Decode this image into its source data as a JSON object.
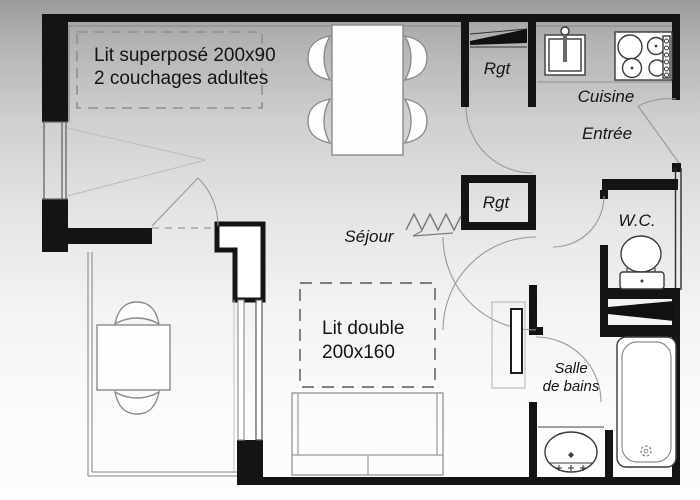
{
  "title": "Plan d'appartement",
  "colors": {
    "wall": "#141414",
    "furniture_line": "#8a8a8a",
    "fixture_line": "#3a3a3a",
    "dashed_zone": "#8f8f8f",
    "background_top": "#9c9c9c",
    "background_bottom": "#fdfdfd",
    "text": "#151515"
  },
  "labels": {
    "bunk_room": {
      "line1": "Lit superposé 200x90",
      "line2": "2 couchages adultes"
    },
    "storage_top": "Rgt",
    "storage_middle": "Rgt",
    "kitchen": "Cuisine",
    "entrance": "Entrée",
    "living_room": "Séjour",
    "wc": "W.C.",
    "double_bed": {
      "line1": "Lit double",
      "line2": "200x160"
    },
    "bathroom": {
      "line1": "Salle",
      "line2": "de bains"
    }
  },
  "fixtures": [
    "bunk-bed-dashed-zone",
    "double-bed-dashed-zone",
    "dining-table",
    "dining-chairs",
    "sofa",
    "balcony-table",
    "balcony-chairs",
    "kitchen-sink",
    "cooktop",
    "toilet",
    "bathtub",
    "washbasin",
    "radiator",
    "radiator-zigzag-symbol",
    "entrance-door",
    "interior-doors",
    "window",
    "sliding-bay-door",
    "balcony-railing"
  ]
}
